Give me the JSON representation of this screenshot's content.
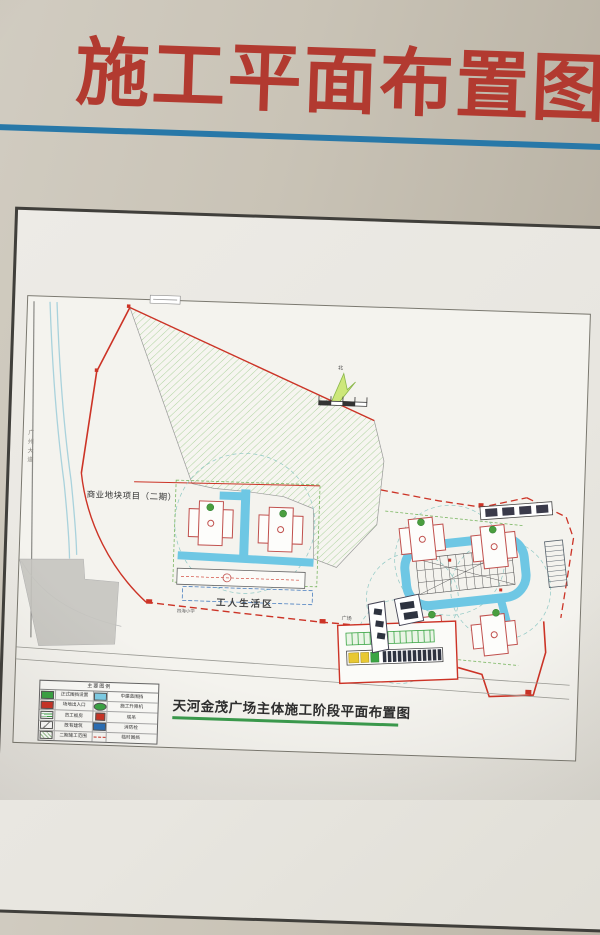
{
  "poster": {
    "title": "施工平面布置图",
    "caption": "天河金茂广场主体施工阶段平面布置图",
    "accent_colors": {
      "title_red": "#b23a30",
      "rule_blue": "#2878a8",
      "underline_green": "#3a9a4c",
      "road_cyan": "#6ec7e4",
      "hatch_green": "#b7d8a6",
      "boundary_red": "#cc3326"
    }
  },
  "plan": {
    "labels": {
      "phase2_block": "商业地块项目（二期）",
      "workers_area": "工人生活区",
      "school": "四海小学",
      "plaza": "广场",
      "road_west": "广州大道",
      "north": "北"
    },
    "legend": {
      "title": "主要图例",
      "rows": [
        {
          "left": "正式围挡设置",
          "right": "中建蓝围挡"
        },
        {
          "left": "场地出入口",
          "right": "施工升降机"
        },
        {
          "left": "员工板房",
          "right": "塔吊"
        },
        {
          "left": "既有建筑",
          "right": "消防栓"
        },
        {
          "left": "二期施工范围",
          "right": "临时围挡"
        }
      ]
    }
  }
}
